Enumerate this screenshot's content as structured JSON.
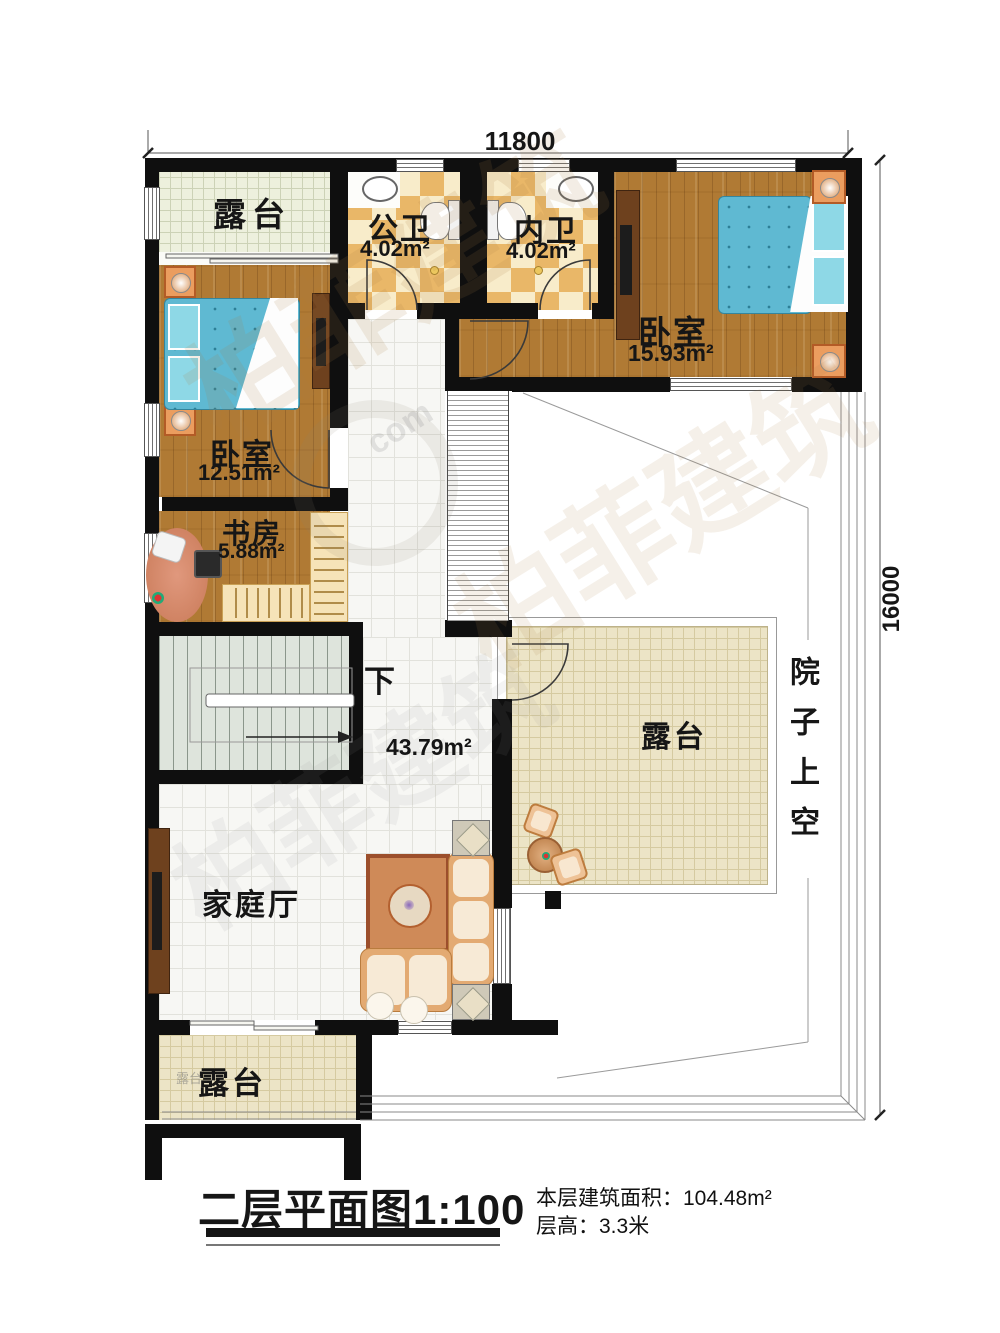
{
  "plan": {
    "dim_top": "11800",
    "dim_right": "16000",
    "terrace_top": "露台",
    "terrace_right": "露台",
    "terrace_bottom": "露台",
    "terrace_bottom_stamp": "露台",
    "bath_public_name": "公卫",
    "bath_public_area": "4.02m²",
    "bath_inner_name": "内卫",
    "bath_inner_area": "4.02m²",
    "bedroom_right_name": "卧室",
    "bedroom_right_area": "15.93m²",
    "bedroom_left_name": "卧室",
    "bedroom_left_area": "12.51m²",
    "study_name": "书房",
    "study_area": "5.88m²",
    "stair_down": "下",
    "hall_area": "43.79m²",
    "hall_name": "家庭厅",
    "courtyard": "院子上空"
  },
  "footer": {
    "title": "二层平面图1:100",
    "area_line": "本层建筑面积：104.48m²",
    "height_line": "层高：3.3米"
  },
  "watermark": {
    "brand": "柏菲建筑",
    "fragment": "com"
  },
  "colors": {
    "wall": "#0f0f0f",
    "wood": "#b07a34",
    "bath_tile": "#e9b768",
    "terrace_tile": "#ece4c6",
    "bed_blue": "#5fb9d2",
    "accent_orange": "#eb9d5f"
  }
}
